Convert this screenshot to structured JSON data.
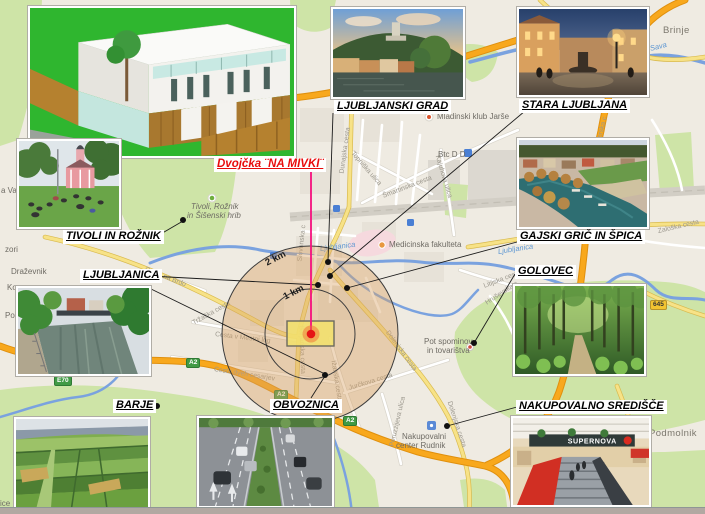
{
  "colors": {
    "accent_pink": "#f5107e",
    "marker_red": "#e51515",
    "motorway_orange": "#f6a31c",
    "label_red": "#e80c0c",
    "ring_fill": "rgba(217,163,100,0.42)"
  },
  "callouts": {
    "grad": "LJUBLJANSKI GRAD",
    "stara": "STARA LJUBLJANA",
    "gajski": "GAJSKI GRIČ IN ŠPICA",
    "golovec": "GOLOVEC",
    "nakupovalno": "NAKUPOVALNO SREDIŠČE",
    "tivoli": "TIVOLI IN ROŽNIK",
    "ljubljanica": "LJUBLJANICA",
    "barje": "BARJE",
    "obvoznica": "OBVOZNICA",
    "project": "Dvojčka ¨NA MIVKI¨"
  },
  "rings": {
    "inner": "1 km",
    "outer": "2 km"
  },
  "map": {
    "places": [
      "Mladinski klub Jarše",
      "Btc D D",
      "Medicinska fakulteta",
      "Tivoli, Rožnik",
      "in Šišenski hrib",
      "Pot spominov",
      "in tovarištva",
      "Nakupovalni",
      "center Rudnik",
      "Brinje",
      "Podmolnik",
      "a Va",
      "zori",
      "Draževnik",
      "Kor",
      "Pod",
      "ice"
    ],
    "streets": [
      "Dunajska cesta",
      "Topniška ulica",
      "Šmartinska cesta",
      "Kajuhova ulica",
      "Štajerska c",
      "Zaloška cesta",
      "Litijska cesta",
      "Hruševska c",
      "Tržaška cesta",
      "Cesta na Brdo",
      "Cesta v Mestni log",
      "Cesta dveh cesarjev",
      "Barjanska cesta",
      "Ižanska cesta",
      "Jurčkova cesta",
      "Dolenjska cesta",
      "Dolenjska cesta",
      "Peruzzijeva ulica",
      "Slovenska c"
    ],
    "waters": [
      "Ljubljanica",
      "Ljubljanica",
      "Sava"
    ],
    "shields": [
      "A2",
      "A2",
      "A2",
      "E70",
      "645"
    ],
    "icons": {
      "poi_orange": "poi-dot-icon",
      "poi_green": "park-poi-icon",
      "parking": "parking-icon",
      "shopping": "shopping-icon"
    }
  },
  "mall_sign": "SUPERNOVA"
}
